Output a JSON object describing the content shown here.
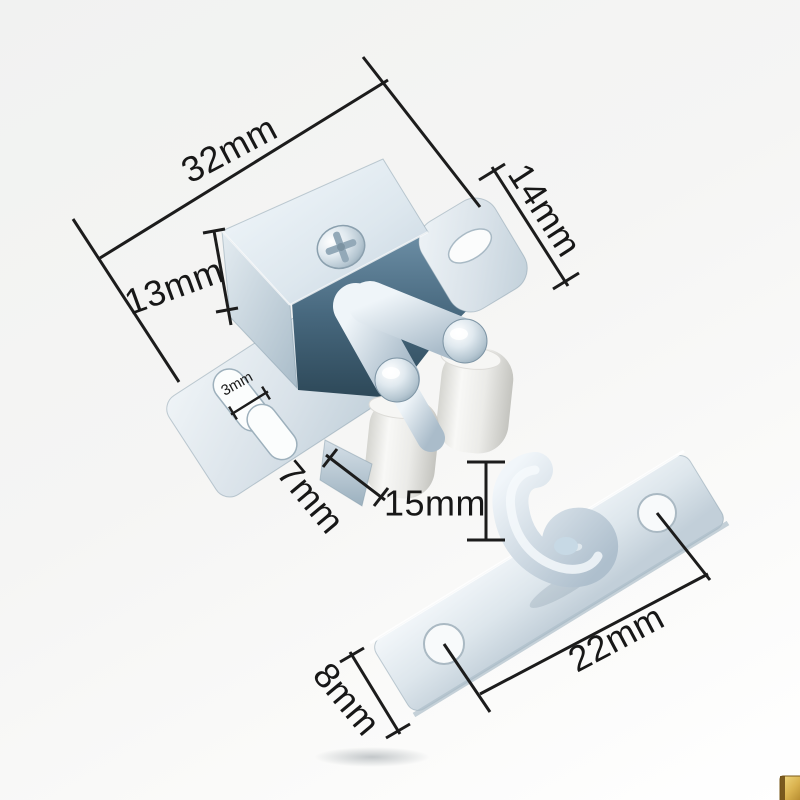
{
  "product_photo": {
    "subject": "Double roller catch cabinet door latch with strike plate, annotated with measurements",
    "annotations": {
      "top_width": {
        "label": "32mm"
      },
      "flange_height": {
        "label": "14mm"
      },
      "body_height": {
        "label": "13mm"
      },
      "slot_width": {
        "label": "3mm"
      },
      "roller_height": {
        "label": "7mm"
      },
      "hook_height": {
        "label": "15mm"
      },
      "hole_spacing": {
        "label": "22mm"
      },
      "plate_width": {
        "label": "8mm"
      }
    },
    "colors": {
      "background_top": "#f1f2f1",
      "background_bottom": "#ffffff",
      "dimension_line": "#1c1c1c",
      "label_text": "#171717",
      "metal_highlight": "#f3f8fb",
      "metal_mid": "#c9d6e0",
      "metal_shadow": "#8fa6b5",
      "cavity_blue": "#3c5d72",
      "roller_white": "#f2f2ef",
      "watermark_gold": "#d9b24f"
    }
  }
}
